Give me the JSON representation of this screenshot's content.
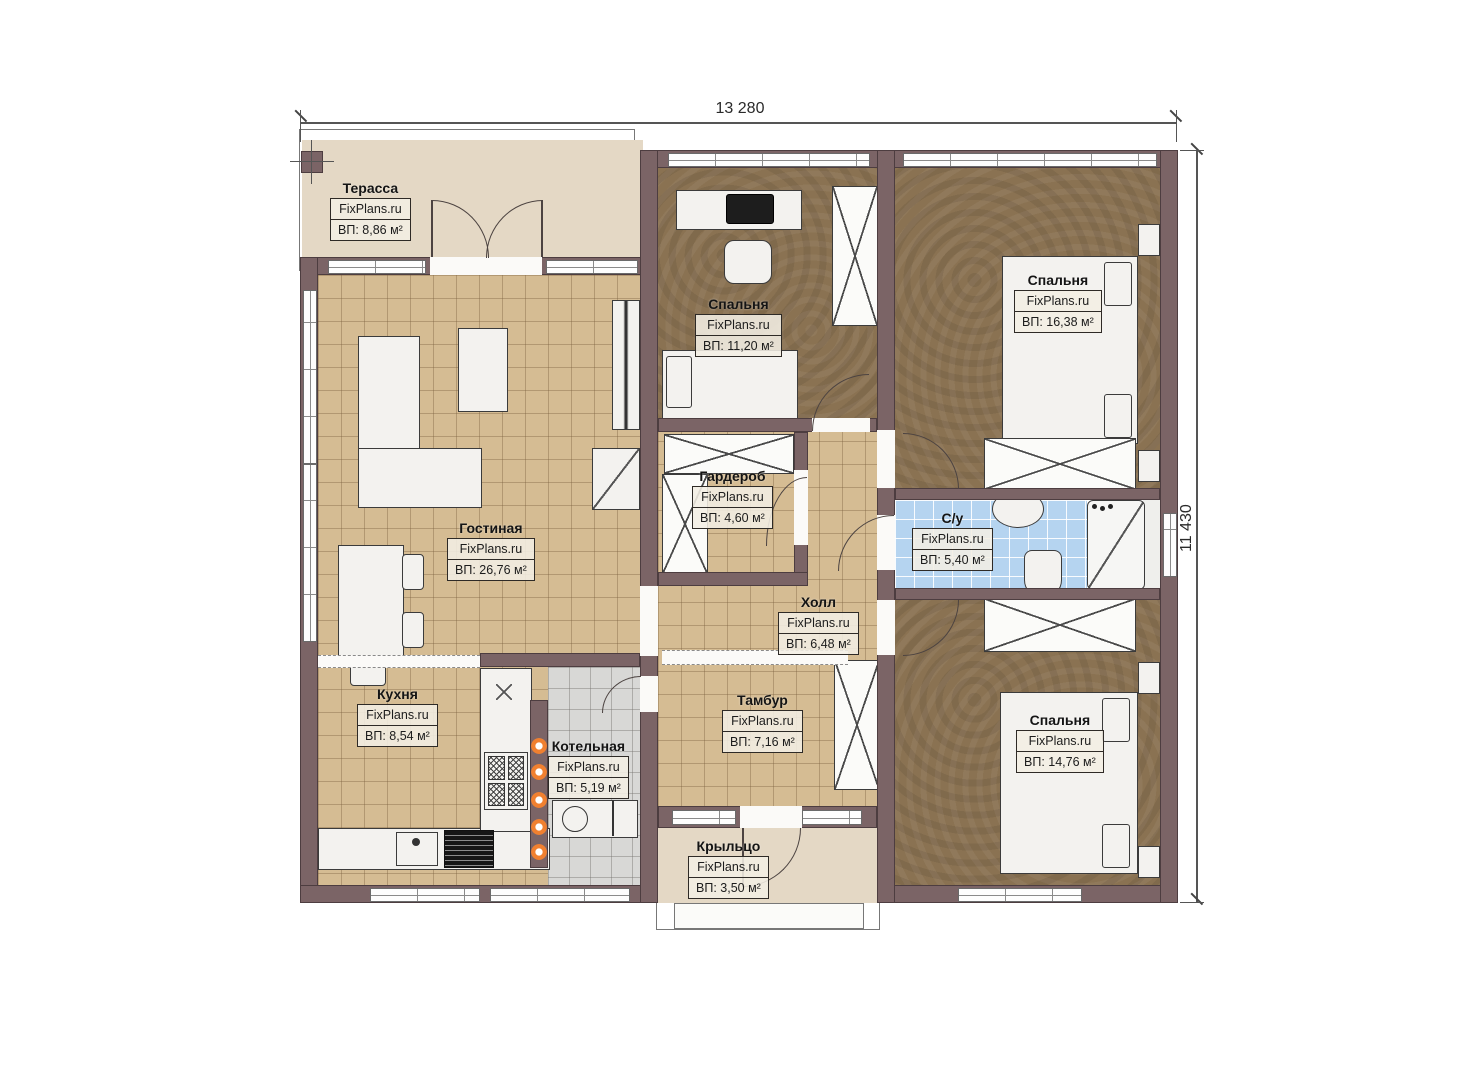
{
  "branding": {
    "watermark": "FixPlans.ru"
  },
  "dimensions": {
    "width_mm": "13 280",
    "height_mm": "11 430"
  },
  "colors": {
    "wall": "#7b6466",
    "floor_tan": "#d5bc93",
    "floor_brown": "#8a7252",
    "floor_blue": "#b5d4f0",
    "floor_gray": "#d8d8d6",
    "floor_beige": "#e4d8c5",
    "accent": "#f08030"
  },
  "rooms": {
    "terrace": {
      "name": "Терасса",
      "area": "ВП: 8,86 м²"
    },
    "living": {
      "name": "Гостиная",
      "area": "ВП: 26,76 м²"
    },
    "kitchen": {
      "name": "Кухня",
      "area": "ВП: 8,54 м²"
    },
    "boiler": {
      "name": "Котельная",
      "area": "ВП: 5,19 м²"
    },
    "bedroom_top": {
      "name": "Спальня",
      "area": "ВП: 11,20 м²"
    },
    "wardrobe": {
      "name": "Гардероб",
      "area": "ВП: 4,60 м²"
    },
    "hall": {
      "name": "Холл",
      "area": "ВП: 6,48 м²"
    },
    "tambour": {
      "name": "Тамбур",
      "area": "ВП: 7,16 м²"
    },
    "bedroom_right_top": {
      "name": "Спальня",
      "area": "ВП: 16,38 м²"
    },
    "bathroom": {
      "name": "С/у",
      "area": "ВП: 5,40 м²"
    },
    "bedroom_right_bottom": {
      "name": "Спальня",
      "area": "ВП: 14,76 м²"
    },
    "porch": {
      "name": "Крыльцо",
      "area": "ВП: 3,50 м²"
    }
  }
}
